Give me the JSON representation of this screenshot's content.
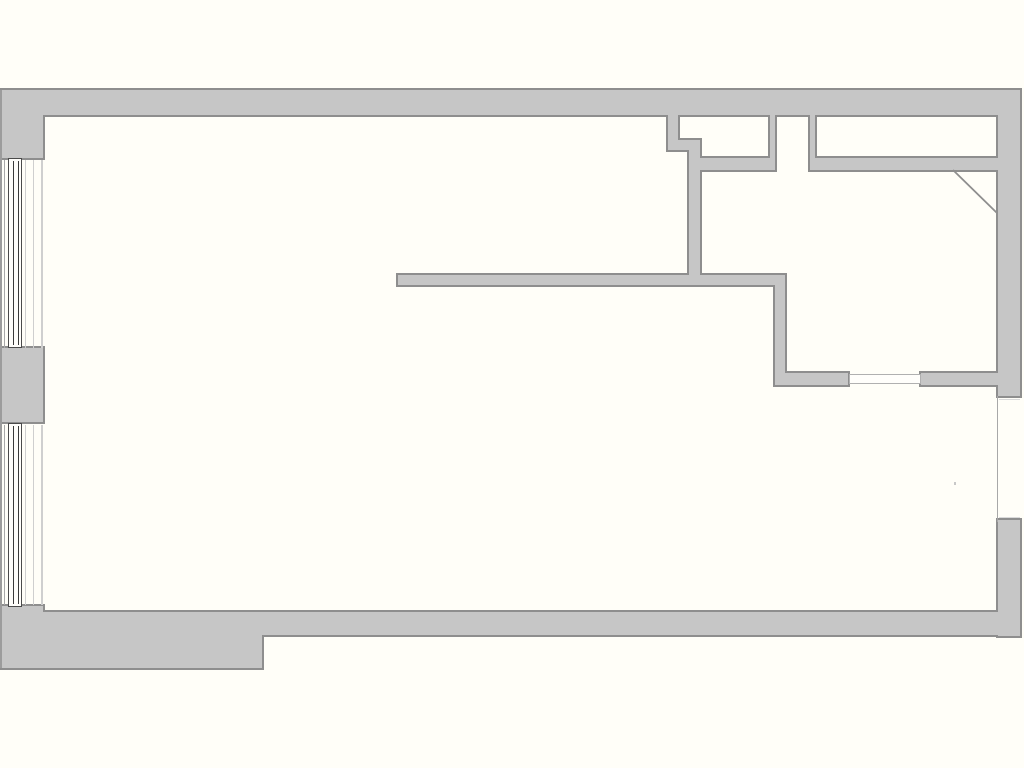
{
  "plan": {
    "type": "floor-plan",
    "canvas": {
      "width": 1024,
      "height": 768
    },
    "colors": {
      "background": "#fffef8",
      "room_fill": "#fffefb",
      "wall_fill": "#c6c6c6",
      "wall_edge": "#8e8e8e",
      "frame_dark": "#4a4a4a",
      "glazing_dark": "#3a3a3a",
      "thin_gray": "#a8a8a8",
      "faint_gray": "#cfcfcf",
      "opening_outline": "#b0b0b0"
    },
    "edge_thickness": 2,
    "walls": [
      {
        "name": "top-wall",
        "x": 0,
        "y": 90,
        "w": 1020,
        "h": 25
      },
      {
        "name": "left-pier-top",
        "x": 0,
        "y": 90,
        "w": 43,
        "h": 68
      },
      {
        "name": "left-pier-middle",
        "x": 0,
        "y": 348,
        "w": 43,
        "h": 74
      },
      {
        "name": "left-pier-bottom",
        "x": 0,
        "y": 606,
        "w": 43,
        "h": 62
      },
      {
        "name": "bottom-wall-left",
        "x": 0,
        "y": 612,
        "w": 262,
        "h": 56
      },
      {
        "name": "bottom-wall-right",
        "x": 258,
        "y": 612,
        "w": 762,
        "h": 23
      },
      {
        "name": "right-wall-upper",
        "x": 998,
        "y": 90,
        "w": 22,
        "h": 306
      },
      {
        "name": "right-wall-lower",
        "x": 998,
        "y": 520,
        "w": 22,
        "h": 116
      },
      {
        "name": "closet-left-jamb",
        "x": 668,
        "y": 113,
        "w": 10,
        "h": 37
      },
      {
        "name": "closet-step-block",
        "x": 668,
        "y": 140,
        "w": 30,
        "h": 10
      },
      {
        "name": "partition-vertical",
        "x": 689,
        "y": 140,
        "w": 11,
        "h": 137
      },
      {
        "name": "wall-under-closet-1",
        "x": 698,
        "y": 158,
        "w": 77,
        "h": 12
      },
      {
        "name": "closet-divider-left",
        "x": 770,
        "y": 113,
        "w": 5,
        "h": 57
      },
      {
        "name": "closet-divider-right",
        "x": 810,
        "y": 113,
        "w": 5,
        "h": 57
      },
      {
        "name": "wall-under-closet-2",
        "x": 810,
        "y": 158,
        "w": 190,
        "h": 12
      },
      {
        "name": "partition-mid",
        "x": 398,
        "y": 275,
        "w": 387,
        "h": 10
      },
      {
        "name": "partition-right",
        "x": 775,
        "y": 275,
        "w": 10,
        "h": 110
      },
      {
        "name": "room-bottom-wall-l",
        "x": 775,
        "y": 373,
        "w": 73,
        "h": 12
      },
      {
        "name": "room-bottom-wall-r",
        "x": 921,
        "y": 373,
        "w": 79,
        "h": 12
      }
    ],
    "window_frames": [
      {
        "name": "window-upper-frame",
        "x": 8,
        "y": 158,
        "w": 14,
        "h": 190
      },
      {
        "name": "window-lower-frame",
        "x": 8,
        "y": 423,
        "w": 14,
        "h": 184
      }
    ],
    "glazing_lines": [
      {
        "name": "window-upper-glazing-a",
        "x": 13,
        "y": 161,
        "w": 1.2,
        "h": 184
      },
      {
        "name": "window-upper-glazing-b",
        "x": 17.5,
        "y": 161,
        "w": 1.2,
        "h": 184
      },
      {
        "name": "window-lower-glazing-a",
        "x": 13,
        "y": 426,
        "w": 1.2,
        "h": 178
      },
      {
        "name": "window-lower-glazing-b",
        "x": 17.5,
        "y": 426,
        "w": 1.2,
        "h": 178
      }
    ],
    "thin_lines": [
      {
        "name": "left-outer-edge-line",
        "x": 0,
        "y": 90,
        "w": 1.5,
        "h": 578,
        "color": "#9c9c9c"
      },
      {
        "name": "window-upper-outer-line",
        "x": 3.5,
        "y": 160,
        "w": 1,
        "h": 188,
        "color": "#a8a8a8"
      },
      {
        "name": "window-upper-reveal-line-a",
        "x": 25,
        "y": 160,
        "w": 1,
        "h": 188,
        "color": "#cfcfcf"
      },
      {
        "name": "window-upper-reveal-line-b",
        "x": 33,
        "y": 160,
        "w": 1,
        "h": 188,
        "color": "#cfcfcf"
      },
      {
        "name": "window-upper-inner-face",
        "x": 41,
        "y": 160,
        "w": 1.5,
        "h": 188,
        "color": "#cfcfcf"
      },
      {
        "name": "window-lower-outer-line",
        "x": 3.5,
        "y": 425,
        "w": 1,
        "h": 180,
        "color": "#a8a8a8"
      },
      {
        "name": "window-lower-reveal-line-a",
        "x": 25,
        "y": 425,
        "w": 1,
        "h": 180,
        "color": "#cfcfcf"
      },
      {
        "name": "window-lower-reveal-line-b",
        "x": 33,
        "y": 425,
        "w": 1,
        "h": 180,
        "color": "#cfcfcf"
      },
      {
        "name": "window-lower-inner-face",
        "x": 41,
        "y": 425,
        "w": 1.5,
        "h": 180,
        "color": "#cfcfcf"
      },
      {
        "name": "right-opening-inner-face",
        "x": 996.5,
        "y": 396,
        "w": 1.5,
        "h": 126,
        "color": "#a8a8a8"
      },
      {
        "name": "right-opening-top-line",
        "x": 999,
        "y": 399,
        "w": 21,
        "h": 1,
        "color": "#dadada"
      },
      {
        "name": "right-opening-bottom-line",
        "x": 999,
        "y": 517,
        "w": 21,
        "h": 1,
        "color": "#dadada"
      },
      {
        "name": "wall-speck",
        "x": 954,
        "y": 482,
        "w": 2,
        "h": 3,
        "color": "#c8c8c8"
      }
    ],
    "door_opening": {
      "name": "door-opening-threshold",
      "x": 849,
      "y": 374,
      "w": 72,
      "h": 10
    },
    "diagonal_wall": {
      "name": "corner-diagonal-line",
      "x1": 953,
      "y1": 170,
      "x2": 997,
      "y2": 213,
      "width": 1.8,
      "color": "#8e8e8e"
    }
  }
}
